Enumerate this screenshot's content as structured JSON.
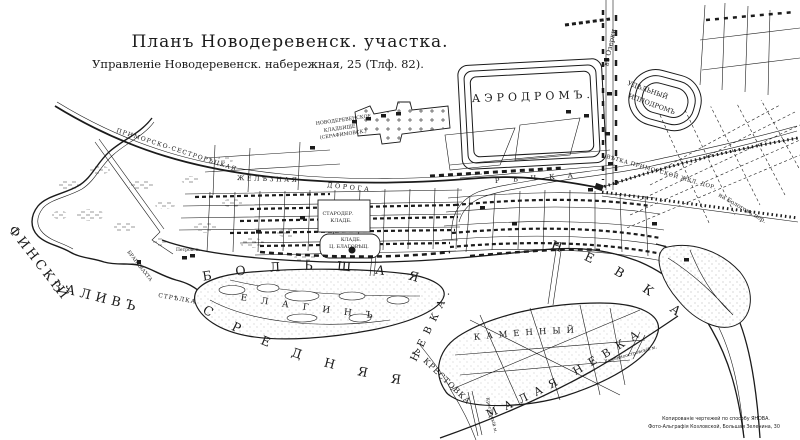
{
  "header": {
    "title": "Планъ Новодеревенск. участка.",
    "subtitle": "Управленіе Новодеревенск. набережная, 25 (Тлф. 82)."
  },
  "labels": {
    "gulf_word1": "ФИНСКІЙ",
    "gulf_word2": "ЗАЛИВЪ",
    "bolshaya": "БОЛЬШАЯ",
    "bolshaya_nevka": "НЕВКА",
    "srednyaya": "СРЕДНЯЯ",
    "srednyaya_nevka": "НЕВКА.",
    "malaya_nevka": "МАЛАЯ  НЕВКА",
    "krestovka": "Р. КРЕСТОВКА",
    "rechka": "РѢЧКА",
    "elagin": "ЕЛАГИНЪ",
    "kamenny": "КАМЕННЫЙ",
    "aerodrome": "АЭРОДРОМЪ.",
    "hippodrome1": "УДѢЛЬНЫЙ",
    "hippodrome2": "ИППОДРОМЪ",
    "ozerki": "въ Озерки",
    "railway1": "ПРИМОРСКО-СЕСТРОРѢЦКАЯ",
    "railway2": "ЖЕЛѢЗНАЯ",
    "railway3": "ДОРОГА",
    "vetka": "ВѢТКА ПРИМОРСКОЙ ЖЕЛ. ДОР.",
    "bologov": "на Бологовъ пер.",
    "cem1a": "НОВОДЕРЕВЕНСКОЕ",
    "cem1b": "КЛАДБИЩЕ",
    "cem1c": "(СЕРАФИМОВСК.)",
    "cem2a": "СТАРОДЕР.",
    "cem2b": "КЛАДБ.",
    "cem3a": "КЛАДБ.",
    "cem3b": "Ц. БЛАГОВѢЩ.",
    "strelka": "СТРѢЛКА",
    "brandvahta": "БРАНДВАХТА",
    "petrovsky": "Петровск.",
    "bridge_kam": "Каменноостровскій м.",
    "bridge_krest": "Крестовскій м."
  },
  "credits": {
    "line1": "Копированіе чертежей по способу ЯНОВА.",
    "line2": "Фото-Альграфія Козловской, Большая Зеленина, 30"
  },
  "colors": {
    "ink": "#1b1b1b",
    "paper": "#ffffff"
  }
}
